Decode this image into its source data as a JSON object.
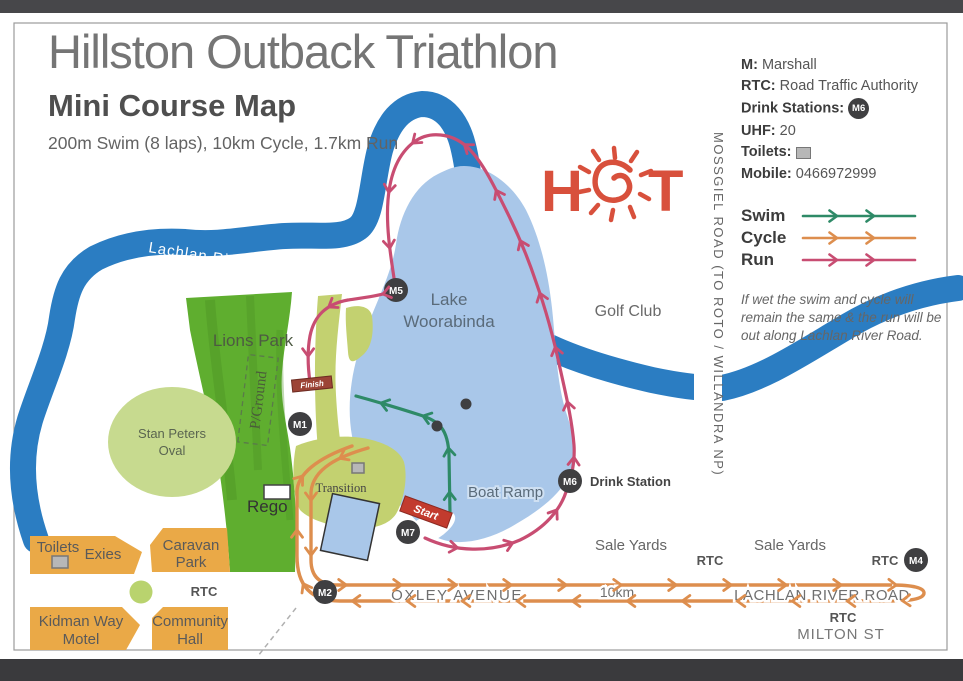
{
  "header": {
    "title": "Hillston Outback Triathlon",
    "subtitle": "Mini Course Map",
    "description": "200m Swim (8 laps), 10km Cycle, 1.7km Run"
  },
  "legend": {
    "m_label": "M:",
    "m_value": "Marshall",
    "rtc_label": "RTC:",
    "rtc_value": "Road Traffic Authority",
    "drink_label": "Drink Stations:",
    "drink_badge": "M6",
    "uhf_label": "UHF:",
    "uhf_value": "20",
    "toilets_label": "Toilets:",
    "mobile_label": "Mobile:",
    "mobile_value": "0466972999",
    "routes": [
      {
        "label": "Swim"
      },
      {
        "label": "Cycle"
      },
      {
        "label": "Run"
      }
    ],
    "note": "If wet the swim and cycle will remain the same & the run will be out along Lachlan River Road."
  },
  "logo": {
    "letter_h": "H",
    "letter_t": "T"
  },
  "map": {
    "river": "Lachlan River",
    "lake_line1": "Lake",
    "lake_line2": "Woorabinda",
    "mossgiel_road": "MOSSGIEL ROAD (TO ROTO / WILLANDRA NP)",
    "golf_club": "Golf Club",
    "lions_park": "Lions Park",
    "oval_line1": "Stan Peters",
    "oval_line2": "Oval",
    "pground": "P/Ground",
    "rego": "Rego",
    "transition": "Transition",
    "boat_ramp": "Boat Ramp",
    "start": "Start",
    "finish": "Finish",
    "drink_station": "Drink Station",
    "oxley": "OXLEY AVENUE",
    "distance": "10km",
    "lachlan_road": "LACHLAN RIVER ROAD",
    "milton": "MILTON ST",
    "sale_yards_left": "Sale Yards",
    "sale_yards_right": "Sale Yards",
    "rtc": "RTC",
    "caravan_line1": "Caravan",
    "caravan_line2": "Park",
    "toilets": "Toilets",
    "exies": "Exies",
    "kidman_line1": "Kidman Way",
    "kidman_line2": "Motel",
    "community_line1": "Community",
    "community_line2": "Hall",
    "markers": {
      "m1": "M1",
      "m2": "M2",
      "m4": "M4",
      "m5": "M5",
      "m6": "M6",
      "m7": "M7"
    }
  },
  "colors": {
    "river": "#2b7dc2",
    "lake": "#a9c7e9",
    "park_green": "#5fae2f",
    "olive": "#c3d170",
    "oval_green": "#c7da8f",
    "block_orange": "#eaa947",
    "swim": "#2e8a67",
    "cycle": "#dd8e4e",
    "run": "#c84d72",
    "marker_dark": "#3f3f41",
    "logo_red": "#d8503c"
  }
}
